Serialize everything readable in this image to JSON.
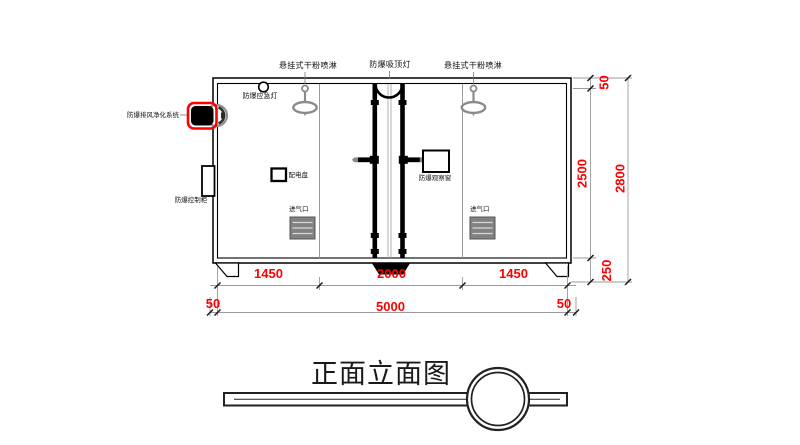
{
  "title_block": {
    "title": "正面立面图"
  },
  "labels": {
    "sprinkler_left": "悬挂式干粉喷淋",
    "ceiling_lamp": "防爆吸顶灯",
    "sprinkler_right": "悬挂式干粉喷淋",
    "emergency_lamp": "防爆应急灯",
    "exhaust_purification": "防爆排风净化系统",
    "control_cabinet": "防爆控制柜",
    "distribution_panel": "配电盘",
    "observation_window": "防爆观察窗",
    "air_inlet_left": "进气口",
    "air_inlet_right": "进气口"
  },
  "dimensions": {
    "horizontal": {
      "segments": [
        "1450",
        "2000",
        "1450"
      ],
      "left_offset": "50",
      "total": "5000",
      "right_offset": "50"
    },
    "vertical": {
      "top_offset": "50",
      "inner_height": "2500",
      "base_height": "250",
      "total": "2800"
    }
  },
  "colors": {
    "dimension_text": "#ff0000",
    "highlight_outline": "#ff0000",
    "line": "#000000",
    "fixture_gray": "#8a8a8a"
  }
}
